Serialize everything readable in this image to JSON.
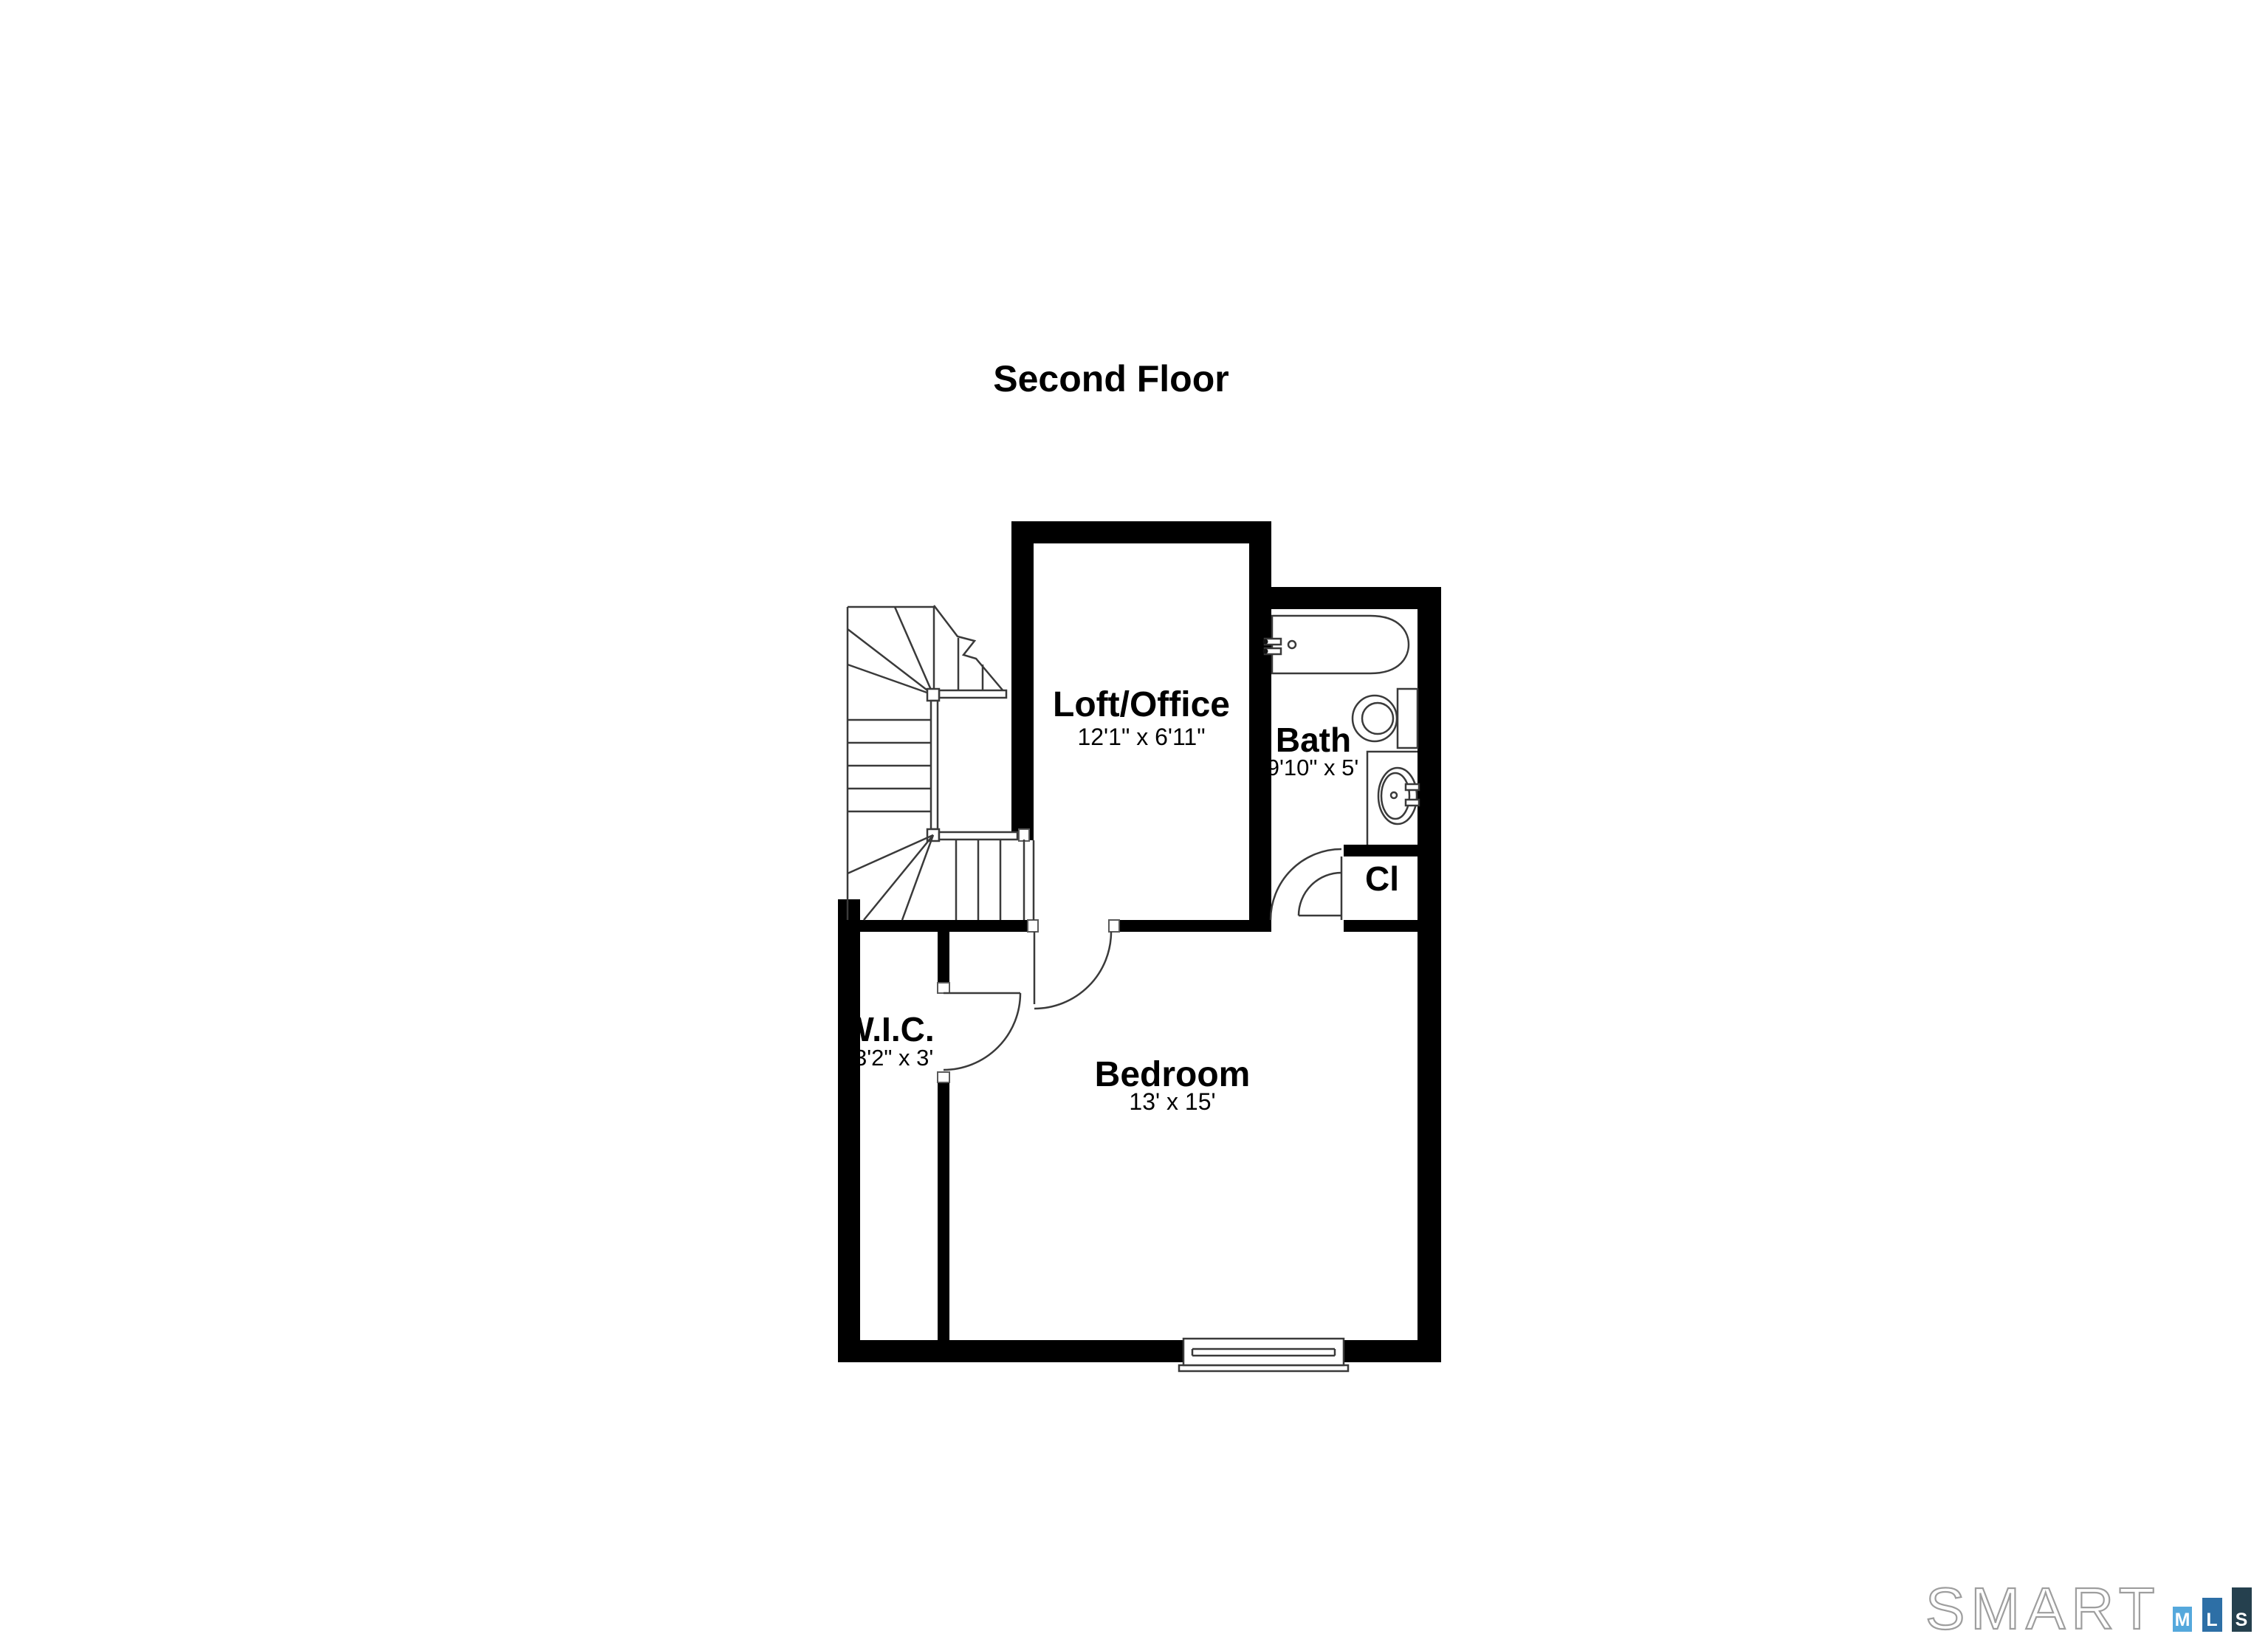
{
  "page": {
    "title": "Second Floor"
  },
  "floor_plan": {
    "rooms": {
      "loft": {
        "name": "Loft/Office",
        "dims": "12'1\" x 6'11\""
      },
      "bath": {
        "name": "Bath",
        "dims": "9'10\" x 5'"
      },
      "closet": {
        "name": "Cl"
      },
      "wic": {
        "name": "W.I.C.",
        "dims": "13'2\" x 3'"
      },
      "bedroom": {
        "name": "Bedroom",
        "dims": "13' x 15'"
      }
    },
    "fixtures": [
      "staircase",
      "bathtub",
      "toilet",
      "sink-vanity",
      "double-hung-window",
      "door-swings"
    ],
    "colors": {
      "wall": "#000000",
      "background": "#ffffff",
      "line": "#3a3a3a"
    }
  },
  "logo": {
    "brand": "SMART",
    "outline_color": "#9e9e9e",
    "bars": [
      {
        "letter": "M",
        "color": "#55A8DC"
      },
      {
        "letter": "L",
        "color": "#2D6FA6"
      },
      {
        "letter": "S",
        "color": "#25404E"
      }
    ]
  }
}
